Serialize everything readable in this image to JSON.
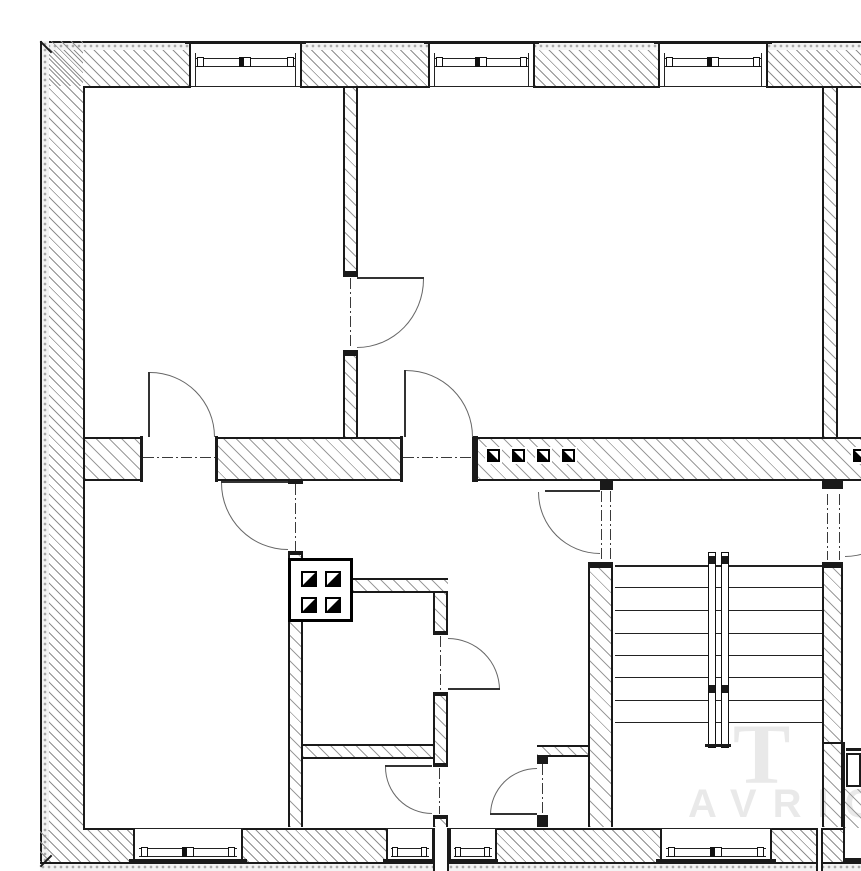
{
  "drawing": {
    "watermark": {
      "glyph": "T",
      "name": "AVRIO"
    },
    "palette": {
      "ink": "#1a1a1a",
      "hatch": "#9b9b9b",
      "paper": "#ffffff",
      "centerline": "#3a3a3a",
      "door_arc": "#666666",
      "watermark": "rgba(70,70,70,0.12)"
    },
    "symbol_counts": {
      "top_windows": 3,
      "bottom_windows": 4,
      "doors": 9,
      "flue_squares_row": 5,
      "flue_squares_box": 4,
      "stair_treads": 8
    }
  }
}
